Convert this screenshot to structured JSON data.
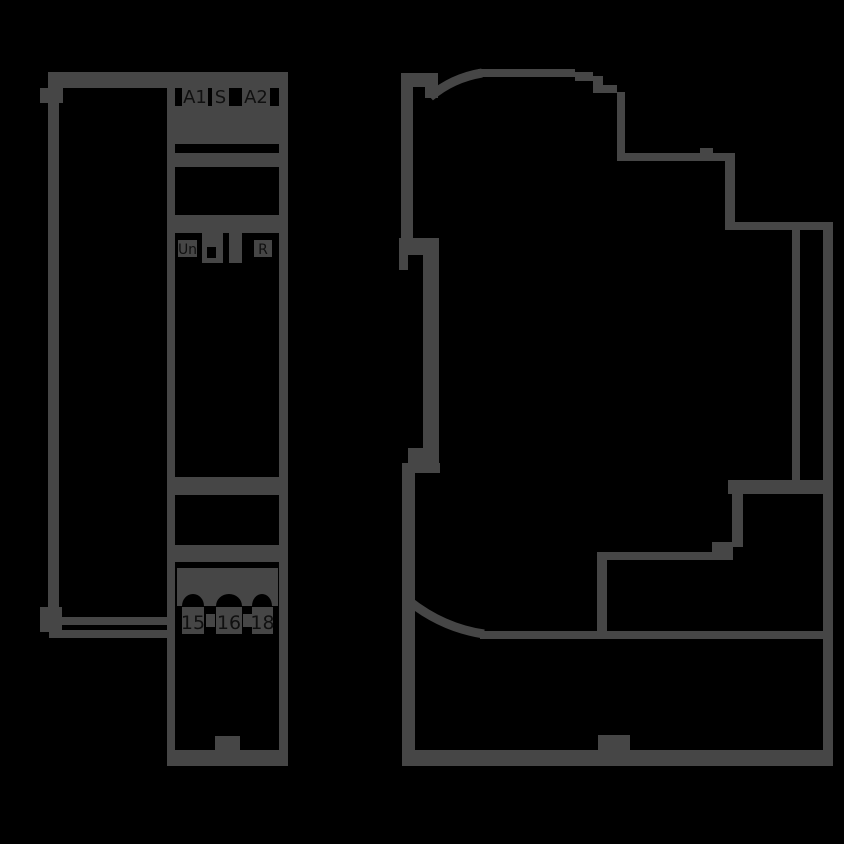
{
  "drawing": {
    "type": "technical-dimensional-drawing",
    "device": "din-rail-module"
  },
  "colors": {
    "background": "#000000",
    "line": "#464646",
    "text": "#101010"
  },
  "front_view": {
    "top_terminals": [
      "A1",
      "S",
      "A2"
    ],
    "indicators": [
      "Un",
      "R"
    ],
    "bottom_terminals": [
      "15",
      "16",
      "18"
    ]
  },
  "side_view": {
    "labels": []
  }
}
